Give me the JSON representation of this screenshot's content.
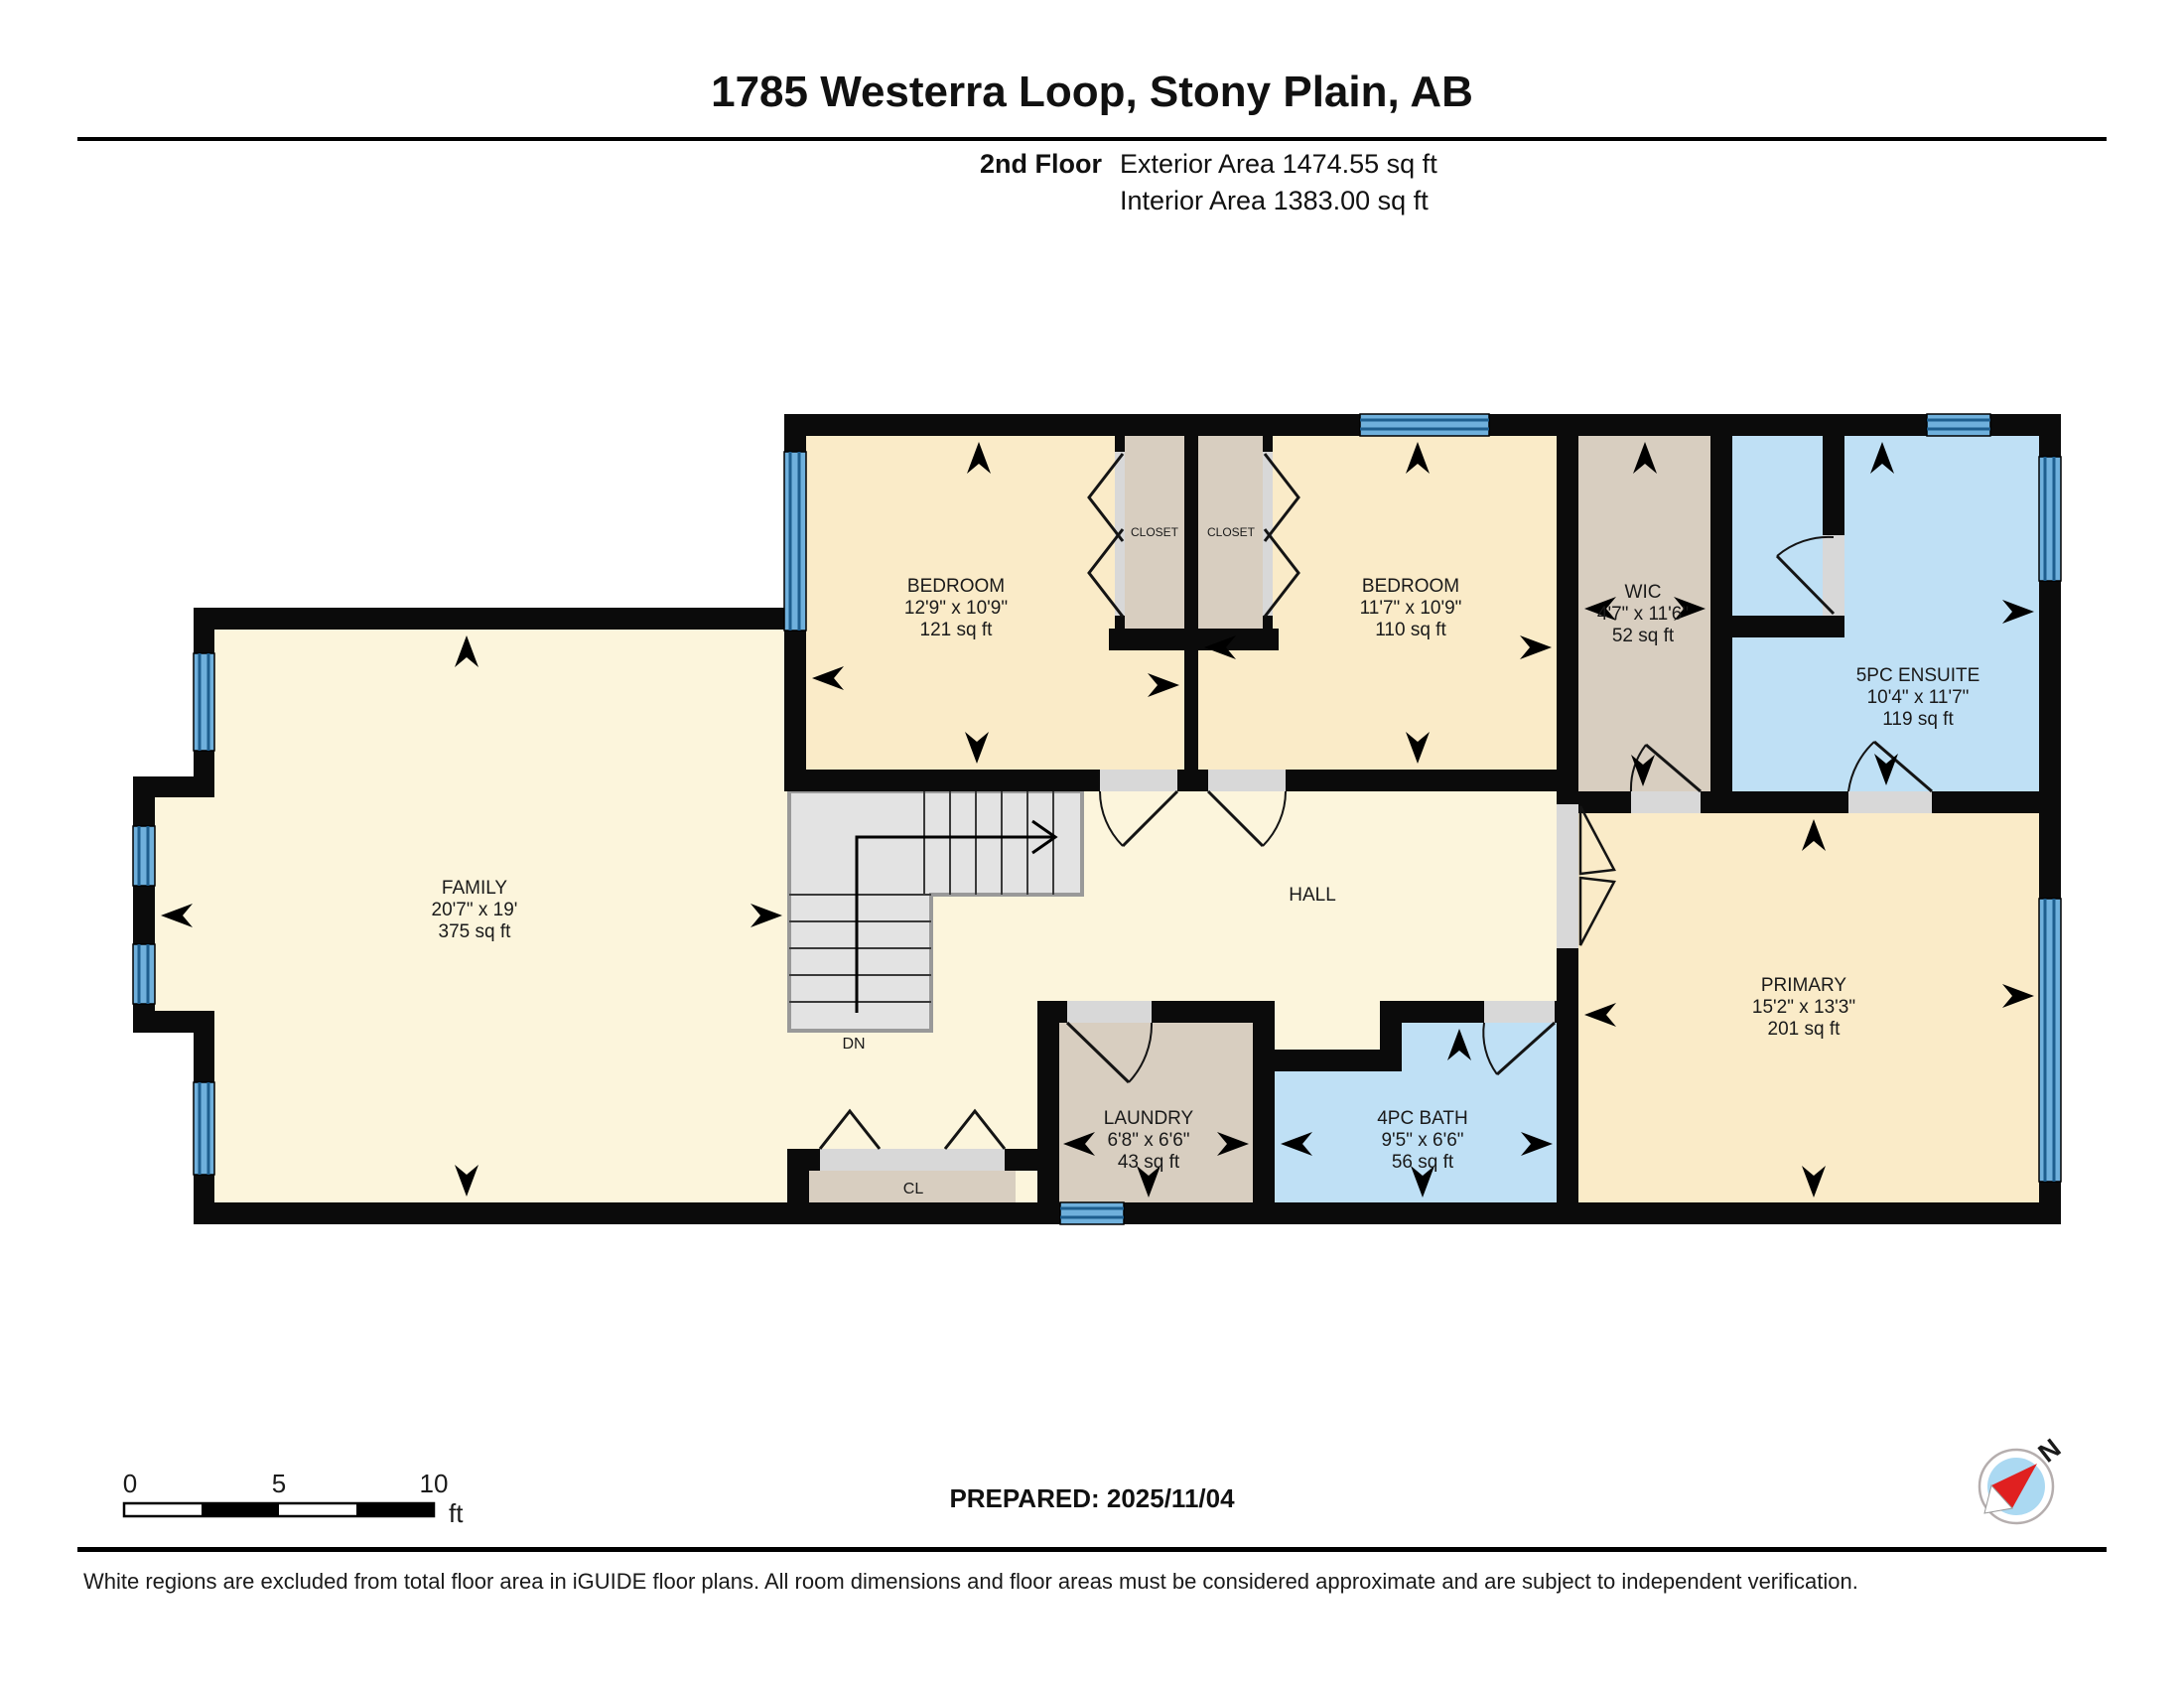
{
  "header": {
    "title": "1785 Westerra Loop, Stony Plain, AB",
    "floor_label": "2nd Floor",
    "exterior_area": "Exterior Area 1474.55 sq ft",
    "interior_area": "Interior Area 1383.00 sq ft"
  },
  "rooms": {
    "family": {
      "name": "FAMILY",
      "dims": "20'7\" x 19'",
      "area": "375 sq ft"
    },
    "bedroom1": {
      "name": "BEDROOM",
      "dims": "12'9\" x 10'9\"",
      "area": "121 sq ft"
    },
    "bedroom2": {
      "name": "BEDROOM",
      "dims": "11'7\" x 10'9\"",
      "area": "110 sq ft"
    },
    "wic": {
      "name": "WIC",
      "dims": "4'7\" x 11'6\"",
      "area": "52 sq ft"
    },
    "ensuite": {
      "name": "5PC ENSUITE",
      "dims": "10'4\" x 11'7\"",
      "area": "119 sq ft"
    },
    "primary": {
      "name": "PRIMARY",
      "dims": "15'2\" x 13'3\"",
      "area": "201 sq ft"
    },
    "laundry": {
      "name": "LAUNDRY",
      "dims": "6'8\" x 6'6\"",
      "area": "43 sq ft"
    },
    "bath": {
      "name": "4PC BATH",
      "dims": "9'5\" x 6'6\"",
      "area": "56 sq ft"
    },
    "hall": {
      "name": "HALL"
    },
    "closet_left": {
      "name": "CLOSET"
    },
    "closet_right": {
      "name": "CLOSET"
    },
    "cl": {
      "name": "CL"
    },
    "stairs": {
      "label": "DN"
    }
  },
  "scale_bar": {
    "start": "0",
    "mid": "5",
    "end": "10",
    "unit": "ft"
  },
  "compass": {
    "north": "N"
  },
  "footer": {
    "prepared": "PREPARED: 2025/11/04",
    "disclaimer": "White regions are excluded from total floor area in iGUIDE floor plans. All room dimensions and floor areas must be considered approximate and are subject to independent verification."
  },
  "colors": {
    "room_light_cream": "#FCF5DC",
    "room_warm_cream": "#FAEBC8",
    "room_tan": "#D8CEC0",
    "room_blue": "#BFE0F5",
    "window_blue": "#6FB0DC",
    "window_stripe": "#1E5E8E",
    "wall_black": "#0B0B0B",
    "stair_gray": "#E3E3E3",
    "compass_red": "#E02020"
  }
}
